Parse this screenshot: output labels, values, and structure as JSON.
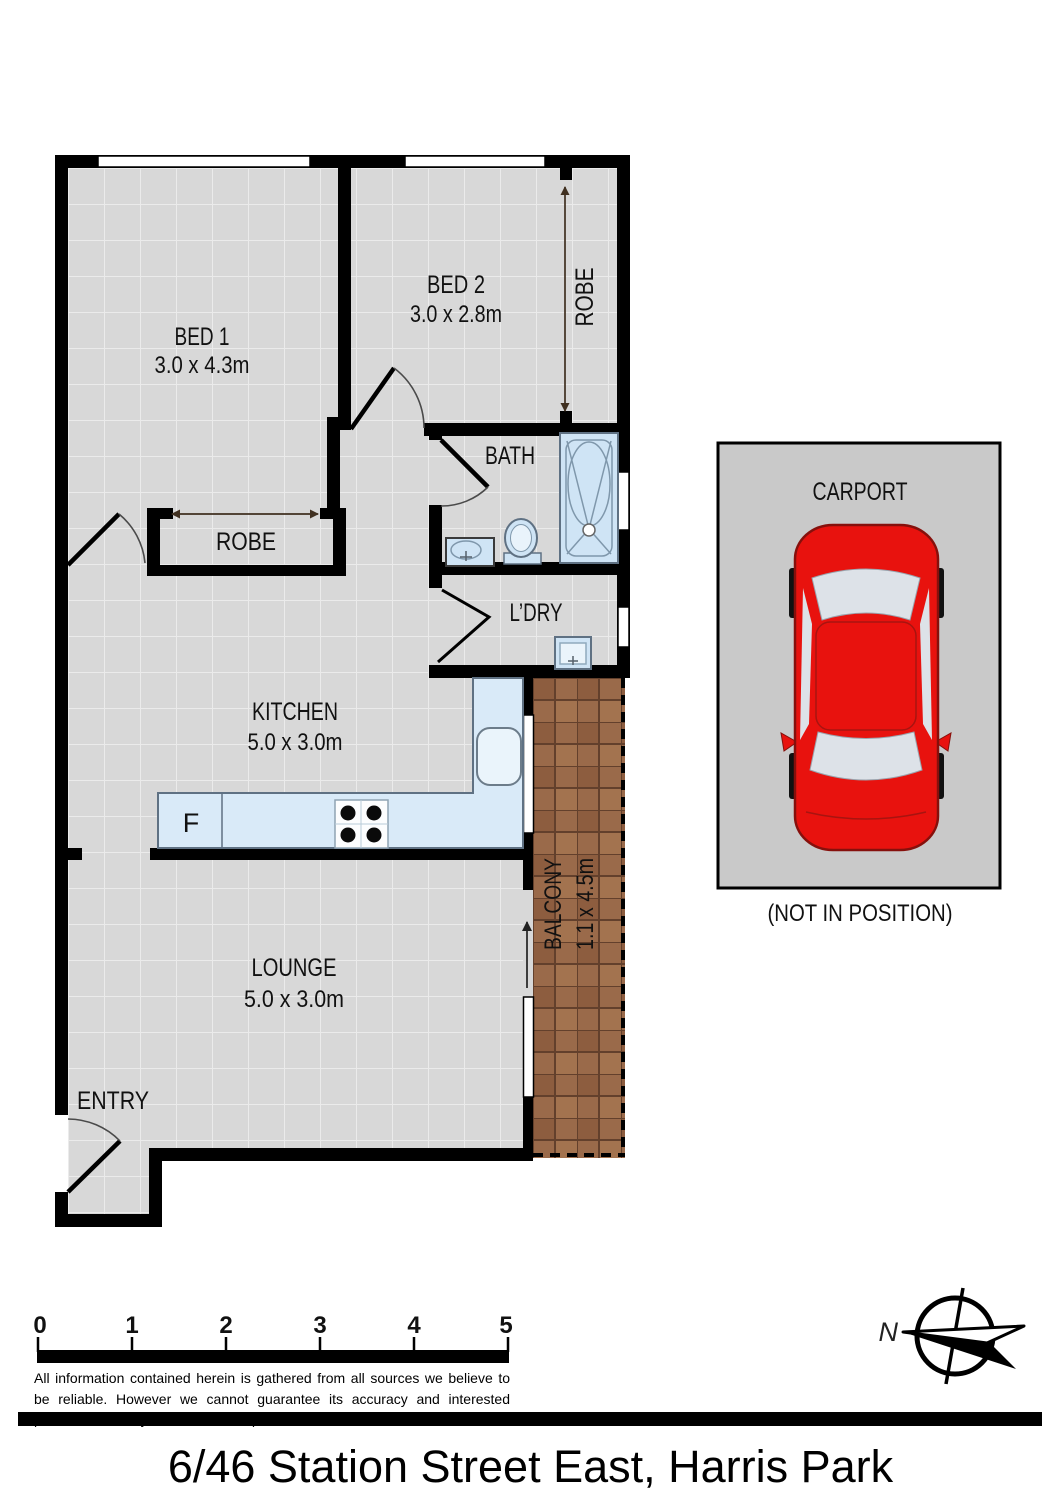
{
  "plan": {
    "rooms": {
      "bed1": {
        "label": "BED 1",
        "dims": "3.0 x 4.3m"
      },
      "bed2": {
        "label": "BED 2",
        "dims": "3.0 x 2.8m"
      },
      "bed2_robe": {
        "label": "ROBE"
      },
      "bed1_robe": {
        "label": "ROBE"
      },
      "bath": {
        "label": "BATH"
      },
      "laundry": {
        "label": "L’DRY"
      },
      "kitchen": {
        "label": "KITCHEN",
        "dims": "5.0 x 3.0m",
        "fridge_label": "F"
      },
      "lounge": {
        "label": "LOUNGE",
        "dims": "5.0 x 3.0m"
      },
      "balcony": {
        "label": "BALCONY",
        "dims": "1.1 x 4.5m"
      },
      "entry": {
        "label": "ENTRY"
      }
    }
  },
  "carport": {
    "label": "CARPORT",
    "note": "(NOT IN POSITION)"
  },
  "compass": {
    "north_label": "N"
  },
  "scale_bar": {
    "ticks": [
      "0",
      "1",
      "2",
      "3",
      "4",
      "5"
    ]
  },
  "footer": {
    "disclaimer": "All information contained herein is gathered from all sources we believe to be reliable. However we cannot guarantee its accuracy and interested parties should rely on their own enquiries.",
    "address_title": "6/46 Station Street East, Harris Park"
  },
  "colors": {
    "wall": "#000000",
    "floor_tile": "#d8d8d8",
    "balcony_tile": "#9a6a4a",
    "fixture_blue": "#cfe4f5",
    "counter_blue": "#d9eaf8",
    "car_red": "#e8120e",
    "carport_gray": "#c9c9c9"
  }
}
